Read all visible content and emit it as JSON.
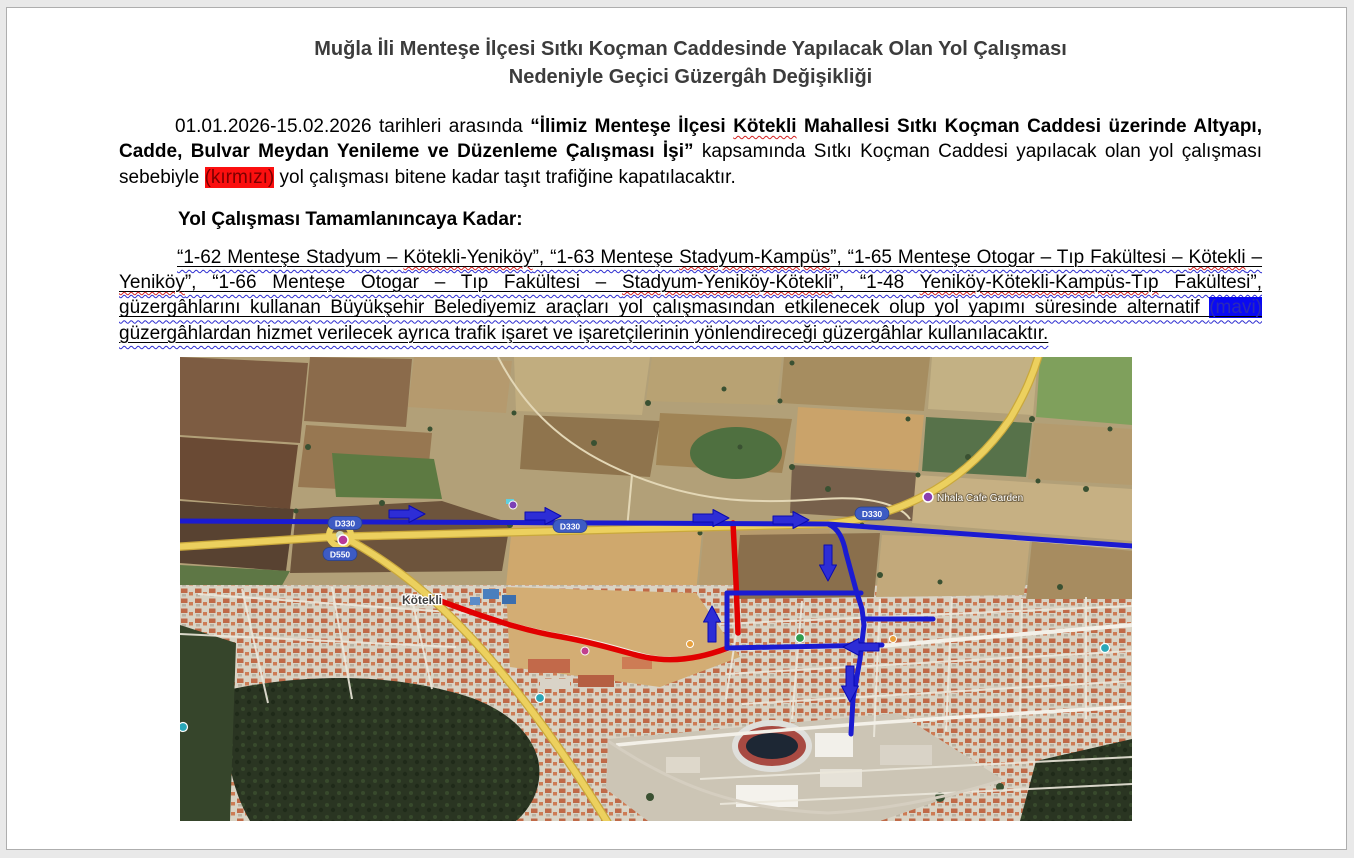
{
  "doc": {
    "title": {
      "line1": "Muğla İli Menteşe İlçesi Sıtkı Koçman Caddesinde Yapılacak Olan Yol Çalışması",
      "line2": "Nedeniyle Geçici Güzergâh Değişikliği"
    },
    "para1": {
      "s1": "01.01.2026-15.02.2026 tarihleri arasında ",
      "s2": "“İlimiz Menteşe İlçesi ",
      "s3": "Kötekli",
      "s4": " Mahallesi Sıtkı Koçman Caddesi üzerinde Altyapı, Cadde, Bulvar Meydan Yenileme ve Düzenleme Çalışması İşi”",
      "s5": " kapsamında Sıtkı Koçman Caddesi yapılacak olan yol çalışması sebebiyle ",
      "s6": "(kırmızı)",
      "s7": " yol çalışması bitene kadar taşıt trafiğine kapatılacaktır."
    },
    "heading": "Yol Çalışması Tamamlanıncaya Kadar:",
    "para2": {
      "s0": "“1-62 Menteşe Stadyum – ",
      "s1": "Kötekli-Yeniköy",
      "s2": "”, “1-63 Menteşe ",
      "s3": "Stadyum-Kampüs",
      "s4": "”, “1-65 Menteşe Otogar – Tıp Fakültesi – ",
      "s5": "Kötekli",
      "s6": " – ",
      "s7": "Yeniköy",
      "s8": "”, “1-66 Menteşe Otogar – Tıp Fakültesi – ",
      "s9": "Stadyum-Yeniköy-Kötekli",
      "s10": "”, “1-48 ",
      "s11": "Yeniköy-Kötekli-Kampüs-Tıp",
      "s12": " Fakültesi”, güzergâhlarını kullanan Büyükşehir Belediyemiz araçları yol çalışmasından etkilenecek olup yol yapımı süresinde alternatif ",
      "s13": "(mavi)",
      "s14": " güzergâhlardan hizmet verilecek ayrıca trafik işaret ve işaretçilerinin yönlendireceği güzergâhlar kullanılacaktır."
    },
    "colors": {
      "closed_route_highlight": "#fb0f0f",
      "alternative_route_highlight": "#0a0af2",
      "closed_route_line": "#e10000",
      "alternative_route_line": "#1b1bd1"
    },
    "map": {
      "labels": {
        "kotekli": "Kötekli",
        "d330": "D330",
        "d550": "D550",
        "cafe": "Nhala Cafe Garden"
      }
    }
  }
}
